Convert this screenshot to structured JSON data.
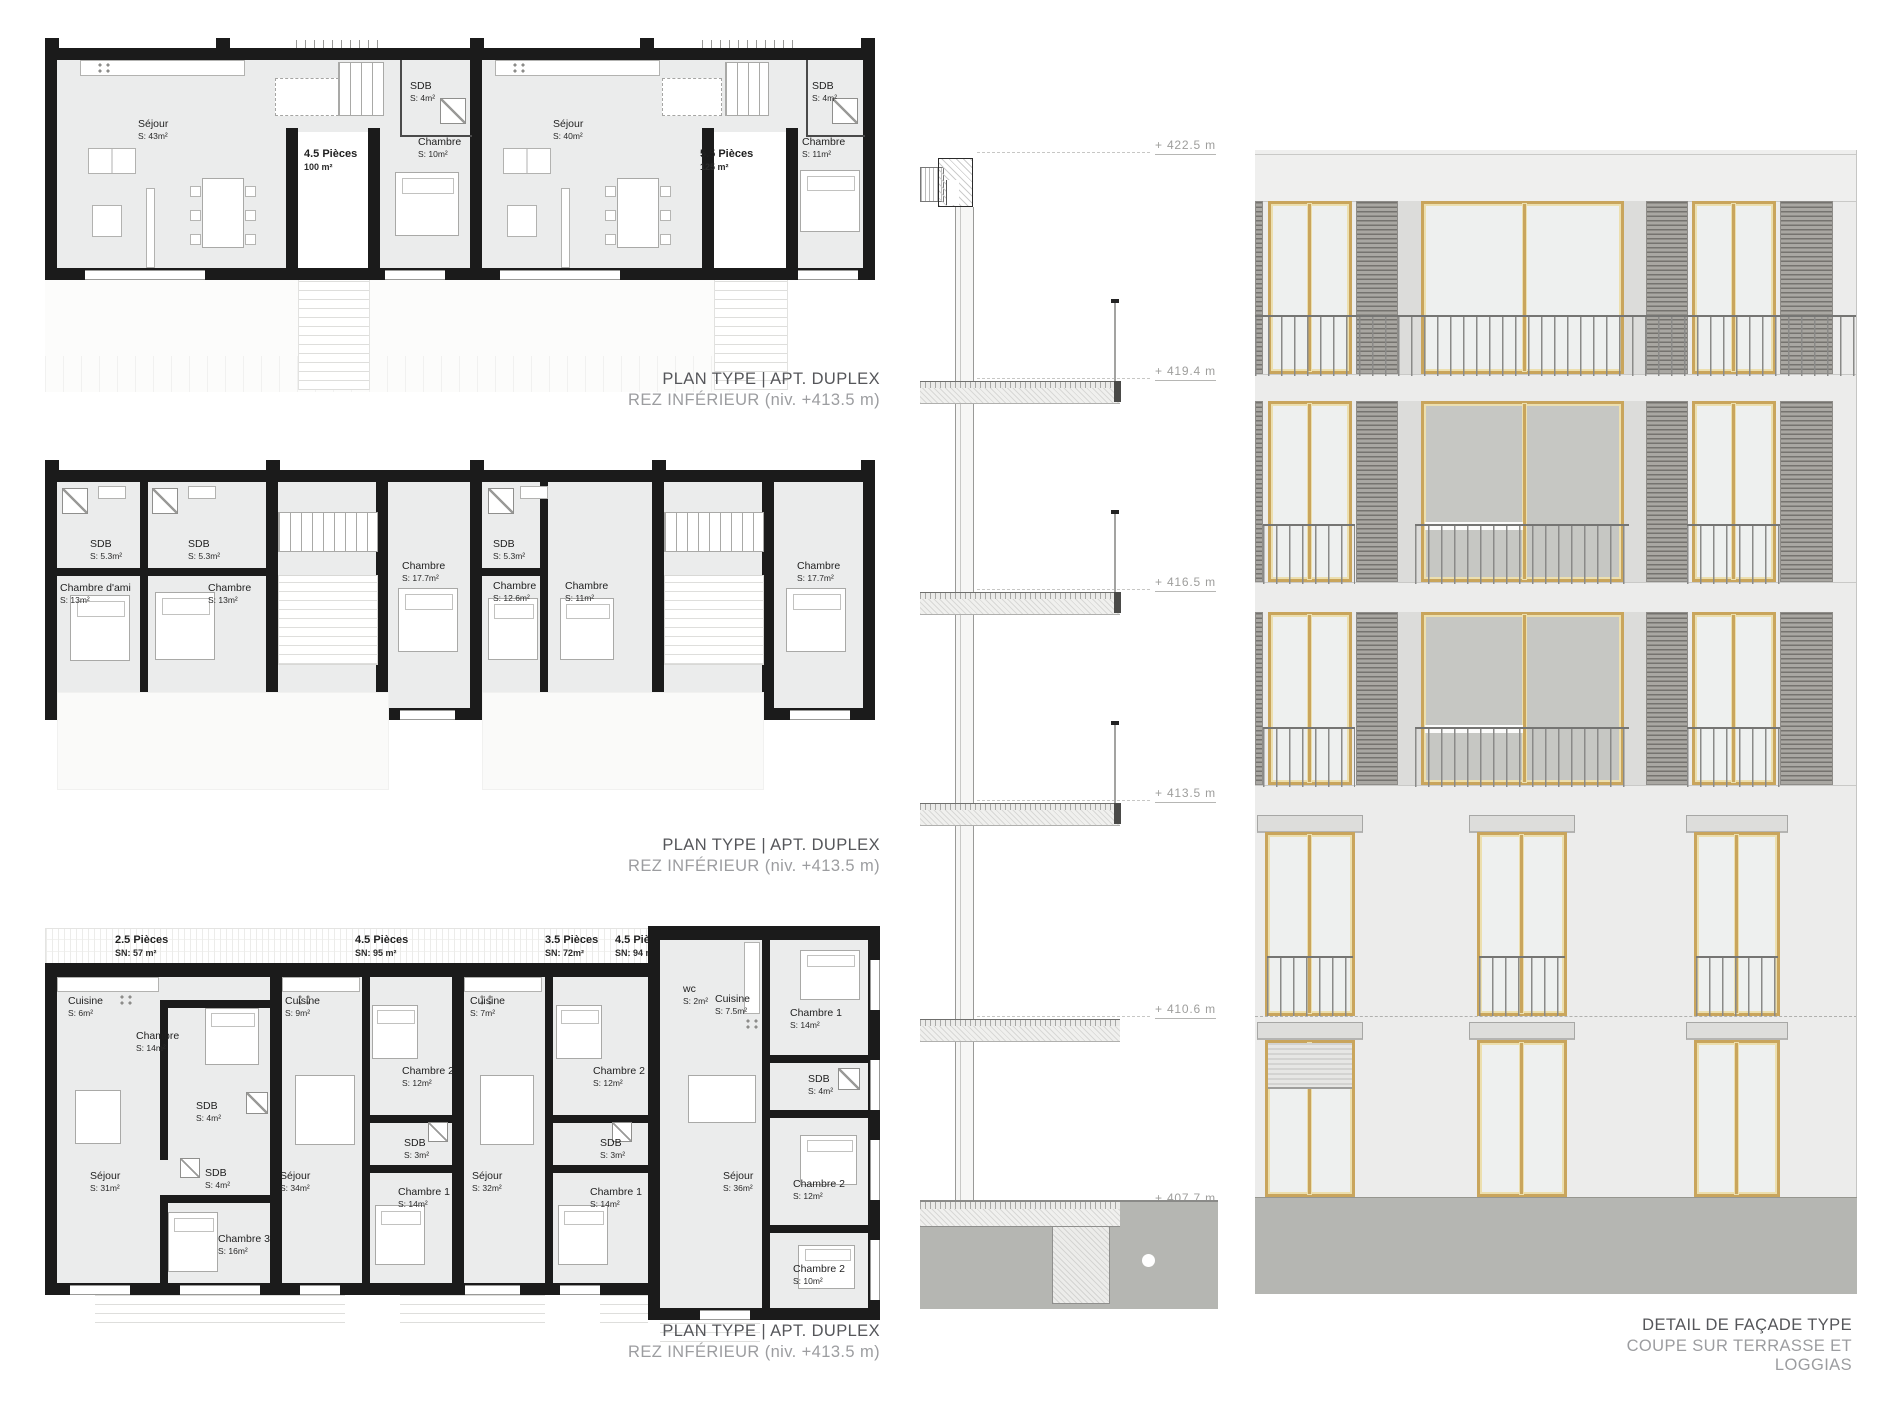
{
  "captions": {
    "plan_top": {
      "title": "PLAN TYPE | APT. DUPLEX",
      "subtitle": "REZ INFÉRIEUR (niv. +413.5 m)"
    },
    "plan_middle": {
      "title": "PLAN TYPE | APT. DUPLEX",
      "subtitle": "REZ INFÉRIEUR (niv. +413.5 m)"
    },
    "plan_bottom": {
      "title": "PLAN TYPE | APT. DUPLEX",
      "subtitle": "REZ INFÉRIEUR (niv. +413.5 m)"
    },
    "facade": {
      "title": "DETAIL DE FAÇADE TYPE",
      "subtitle": "COUPE SUR TERRASSE ET LOGGIAS"
    }
  },
  "plan_top": {
    "unit_a": {
      "type": "4.5 Pièces",
      "type_area": "100 m²",
      "sejour": {
        "label": "Séjour",
        "area": "S: 43m²"
      },
      "sdb": {
        "label": "SDB",
        "area": "S: 4m²"
      },
      "chambre": {
        "label": "Chambre",
        "area": "S: 10m²"
      }
    },
    "unit_b": {
      "type": "5.5 Pièces",
      "type_area": "125 m²",
      "sejour": {
        "label": "Séjour",
        "area": "S: 40m²"
      },
      "sdb": {
        "label": "SDB",
        "area": "S: 4m²"
      },
      "chambre": {
        "label": "Chambre",
        "area": "S: 11m²"
      }
    }
  },
  "plan_middle": {
    "rooms": [
      {
        "label": "SDB",
        "area": "S: 5.3m²"
      },
      {
        "label": "SDB",
        "area": "S: 5.3m²"
      },
      {
        "label": "Chambre d'ami",
        "area": "S: 13m²"
      },
      {
        "label": "Chambre",
        "area": "S: 13m²"
      },
      {
        "label": "Chambre",
        "area": "S: 17.7m²"
      },
      {
        "label": "SDB",
        "area": "S: 5.3m²"
      },
      {
        "label": "Chambre",
        "area": "S: 12.6m²"
      },
      {
        "label": "Chambre",
        "area": "S: 11m²"
      },
      {
        "label": "Chambre",
        "area": "S: 17.7m²"
      }
    ]
  },
  "plan_bottom": {
    "unit_headers": [
      {
        "type": "2.5 Pièces",
        "sn": "SN: 57 m²"
      },
      {
        "type": "4.5 Pièces",
        "sn": "SN: 95 m²"
      },
      {
        "type": "3.5 Pièces",
        "sn": "SN: 72m²"
      },
      {
        "type": "4.5 Pièces",
        "sn": "SN: 94 m²"
      }
    ],
    "rooms": [
      {
        "label": "Cuisine",
        "area": "S: 6m²"
      },
      {
        "label": "Chambre",
        "area": "S: 14m²"
      },
      {
        "label": "SDB",
        "area": "S: 4m²"
      },
      {
        "label": "Séjour",
        "area": "S: 31m²"
      },
      {
        "label": "SDB",
        "area": "S: 4m²"
      },
      {
        "label": "Chambre 3",
        "area": "S: 16m²"
      },
      {
        "label": "Cuisine",
        "area": "S: 9m²"
      },
      {
        "label": "Séjour",
        "area": "S: 34m²"
      },
      {
        "label": "Chambre 2",
        "area": "S: 12m²"
      },
      {
        "label": "SDB",
        "area": "S: 3m²"
      },
      {
        "label": "Chambre 1",
        "area": "S: 14m²"
      },
      {
        "label": "Cuisine",
        "area": "S: 7m²"
      },
      {
        "label": "Séjour",
        "area": "S: 32m²"
      },
      {
        "label": "Chambre 2",
        "area": "S: 12m²"
      },
      {
        "label": "SDB",
        "area": "S: 3m²"
      },
      {
        "label": "Chambre 1",
        "area": "S: 14m²"
      },
      {
        "label": "wc",
        "area": "S: 2m²"
      },
      {
        "label": "Cuisine",
        "area": "S: 7.5m²"
      },
      {
        "label": "Chambre 1",
        "area": "S: 14m²"
      },
      {
        "label": "SDB",
        "area": "S: 4m²"
      },
      {
        "label": "Séjour",
        "area": "S: 36m²"
      },
      {
        "label": "Chambre 2",
        "area": "S: 12m²"
      },
      {
        "label": "Chambre 2",
        "area": "S: 10m²"
      }
    ]
  },
  "section": {
    "levels": [
      {
        "label": "+ 422.5 m"
      },
      {
        "label": "+ 419.4 m"
      },
      {
        "label": "+ 416.5 m"
      },
      {
        "label": "+ 413.5 m"
      },
      {
        "label": "+ 410.6 m"
      },
      {
        "label": "+ 407.7 m"
      }
    ]
  },
  "colors": {
    "wall_black": "#1b1b1b",
    "floor_gray": "#ebecec",
    "frame_gold": "#c9a55c",
    "glass_light": "#eef0ef",
    "glass_dark": "#c6c7c3",
    "shutter_dark": "#75736f",
    "ground_gray": "#b5b6b2",
    "caption_dark": "#55565a",
    "caption_light": "#9c9da0"
  }
}
